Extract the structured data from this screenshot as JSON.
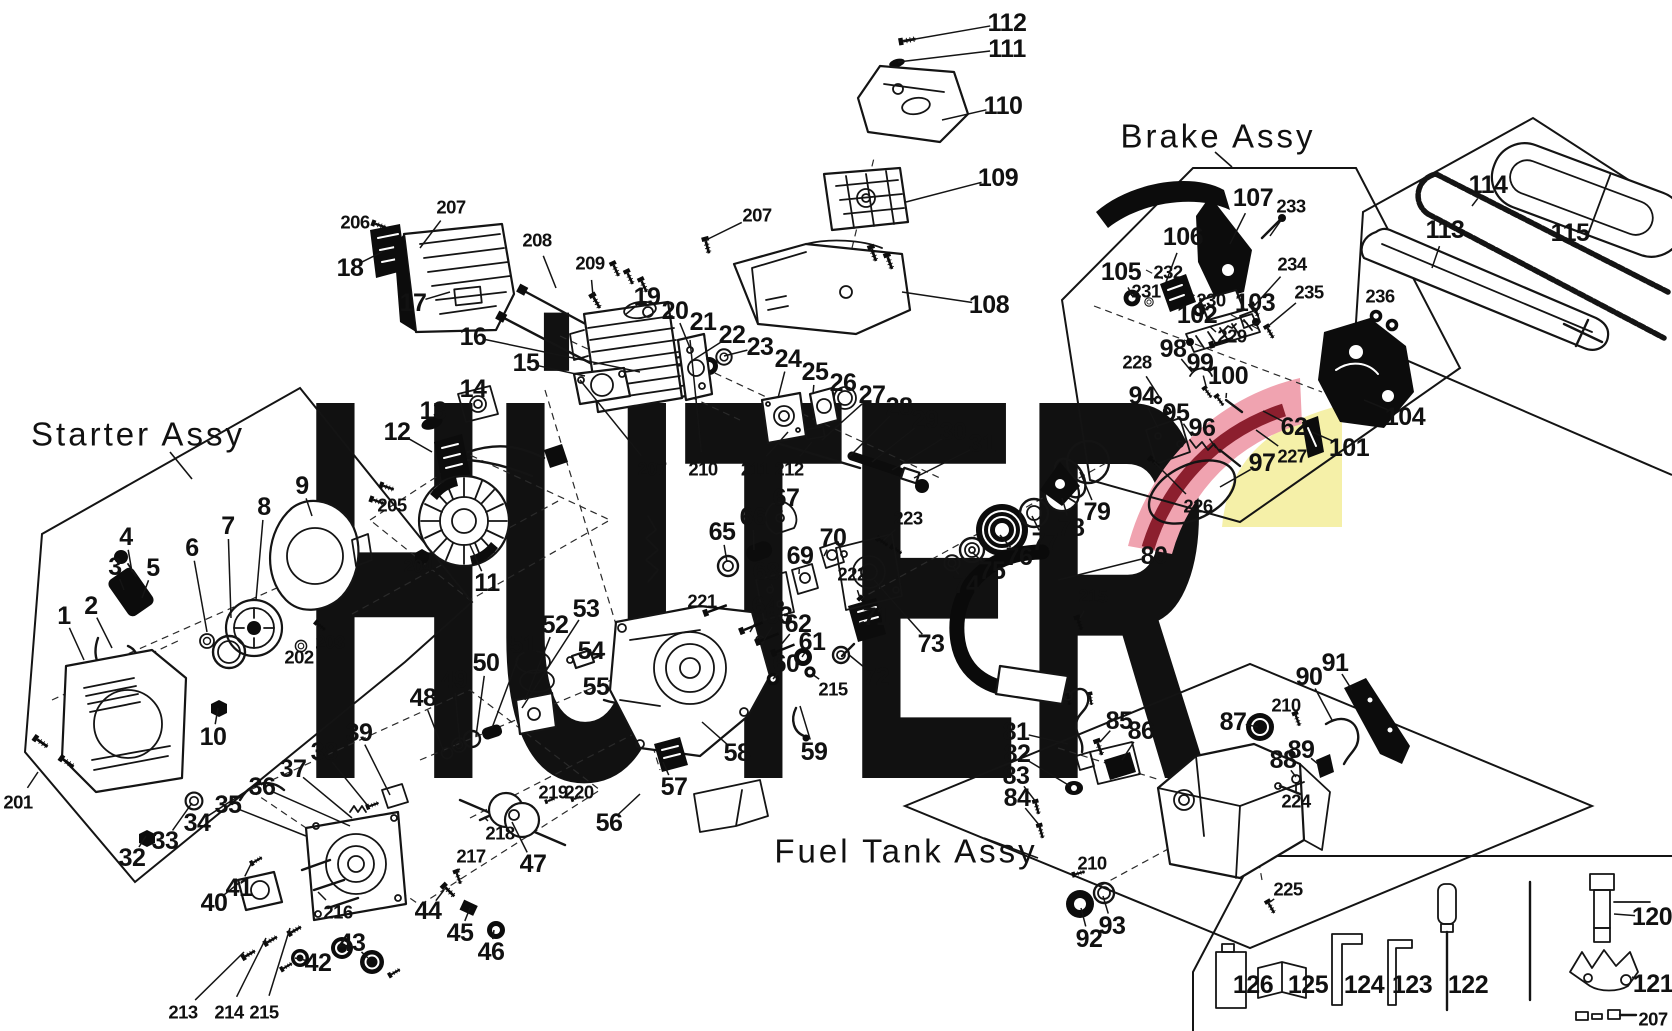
{
  "watermark": {
    "text": "HÜTER",
    "color": "#c9c9c9",
    "accent_pink": "#f0a3b0",
    "accent_red": "#8c1f2e",
    "accent_yellow": "#f5f0a8"
  },
  "assemblies": [
    {
      "label": "Starter Assy",
      "x": 138,
      "y": 434,
      "leader": [
        170,
        452,
        192,
        479
      ]
    },
    {
      "label": "Brake Assy",
      "x": 1218,
      "y": 136,
      "leader": [
        1215,
        152,
        1232,
        167
      ]
    },
    {
      "label": "Fuel Tank Assy",
      "x": 906,
      "y": 851,
      "leader": [
        984,
        838,
        1038,
        858
      ]
    }
  ],
  "part_labels": [
    [
      "1",
      64,
      616,
      84,
      660
    ],
    [
      "2",
      91,
      606,
      112,
      648
    ],
    [
      "3",
      115,
      567,
      124,
      590
    ],
    [
      "4",
      126,
      537,
      132,
      572
    ],
    [
      "5",
      153,
      568,
      142,
      598
    ],
    [
      "6",
      192,
      548,
      207,
      632
    ],
    [
      "7",
      228,
      526,
      231,
      618
    ],
    [
      "8",
      264,
      507,
      256,
      600
    ],
    [
      "9",
      302,
      486,
      312,
      516
    ],
    [
      "10",
      213,
      737,
      218,
      708
    ],
    [
      "11",
      487,
      583,
      470,
      545
    ],
    [
      "12",
      397,
      432,
      432,
      452
    ],
    [
      "13",
      433,
      411,
      430,
      424
    ],
    [
      "14",
      473,
      389,
      470,
      402
    ],
    [
      "15",
      526,
      363,
      585,
      376
    ],
    [
      "16",
      473,
      337,
      640,
      372
    ],
    [
      "17",
      413,
      303,
      450,
      292
    ],
    [
      "18",
      350,
      268,
      382,
      252
    ],
    [
      "19",
      647,
      297,
      625,
      315
    ],
    [
      "20",
      675,
      311,
      690,
      348
    ],
    [
      "21",
      703,
      322,
      707,
      360
    ],
    [
      "22",
      732,
      335,
      690,
      362
    ],
    [
      "23",
      760,
      347,
      724,
      356
    ],
    [
      "24",
      788,
      359,
      778,
      398
    ],
    [
      "25",
      815,
      372,
      813,
      394
    ],
    [
      "26",
      843,
      383,
      842,
      392
    ],
    [
      "27",
      872,
      395,
      822,
      440
    ],
    [
      "28",
      899,
      407,
      850,
      456
    ],
    [
      "29",
      925,
      420,
      872,
      462
    ],
    [
      "30",
      953,
      432,
      892,
      470
    ],
    [
      "31",
      982,
      444,
      914,
      478
    ],
    [
      "32",
      132,
      858,
      146,
      836
    ],
    [
      "33",
      165,
      841,
      192,
      803
    ],
    [
      "34",
      197,
      823,
      248,
      790
    ],
    [
      "35",
      228,
      805,
      306,
      836
    ],
    [
      "36",
      262,
      787,
      350,
      826
    ],
    [
      "37",
      293,
      769,
      352,
      818
    ],
    [
      "38",
      324,
      752,
      368,
      806
    ],
    [
      "39",
      359,
      733,
      390,
      795
    ],
    [
      "40",
      214,
      903,
      240,
      882
    ],
    [
      "41",
      239,
      888,
      252,
      862
    ],
    [
      "42",
      318,
      963,
      295,
      958
    ],
    [
      "43",
      352,
      943,
      368,
      958
    ],
    [
      "44",
      428,
      911,
      444,
      890
    ],
    [
      "45",
      460,
      933,
      470,
      908
    ],
    [
      "46",
      491,
      952,
      494,
      930
    ],
    [
      "47",
      533,
      864,
      512,
      822
    ],
    [
      "48",
      423,
      698,
      444,
      752
    ],
    [
      "49",
      454,
      680,
      460,
      744
    ],
    [
      "50",
      486,
      663,
      476,
      736
    ],
    [
      "51",
      523,
      645,
      492,
      728
    ],
    [
      "52",
      555,
      625,
      525,
      700
    ],
    [
      "53",
      586,
      609,
      522,
      708
    ],
    [
      "54",
      591,
      651,
      580,
      662
    ],
    [
      "55",
      596,
      687,
      608,
      696
    ],
    [
      "56",
      609,
      823,
      640,
      794
    ],
    [
      "57",
      674,
      787,
      663,
      762
    ],
    [
      "58",
      737,
      753,
      702,
      722
    ],
    [
      "59",
      814,
      752,
      800,
      706
    ],
    [
      "60",
      786,
      664,
      773,
      679
    ],
    [
      "61",
      812,
      642,
      802,
      657
    ],
    [
      "62",
      798,
      624,
      780,
      646
    ],
    [
      "63",
      779,
      616,
      764,
      640
    ],
    [
      "64",
      765,
      606,
      750,
      632
    ],
    [
      "65",
      722,
      532,
      727,
      562
    ],
    [
      "66",
      753,
      517,
      754,
      550
    ],
    [
      "67",
      786,
      498,
      780,
      518
    ],
    [
      "68",
      766,
      572,
      774,
      590
    ],
    [
      "69",
      800,
      556,
      799,
      574
    ],
    [
      "70",
      833,
      538,
      824,
      556
    ],
    [
      "71",
      876,
      617,
      858,
      624
    ],
    [
      "72",
      876,
      677,
      848,
      654
    ],
    [
      "73",
      931,
      644,
      874,
      580
    ],
    [
      "74",
      966,
      585,
      953,
      566
    ],
    [
      "75",
      992,
      571,
      972,
      552
    ],
    [
      "76",
      1019,
      557,
      1000,
      535
    ],
    [
      "77",
      1045,
      542,
      1032,
      516
    ],
    [
      "78",
      1071,
      528,
      1062,
      498
    ],
    [
      "79",
      1097,
      512,
      1080,
      472
    ],
    [
      "80",
      1154,
      556,
      1058,
      580
    ],
    [
      "81",
      1016,
      732,
      1068,
      744
    ],
    [
      "82",
      1017,
      754,
      1070,
      786
    ],
    [
      "83",
      1016,
      776,
      1036,
      802
    ],
    [
      "84",
      1017,
      798,
      1040,
      826
    ],
    [
      "85",
      1119,
      721,
      1100,
      742
    ],
    [
      "86",
      1141,
      731,
      1122,
      760
    ],
    [
      "87",
      1233,
      722,
      1258,
      727
    ],
    [
      "88",
      1283,
      760,
      1296,
      777
    ],
    [
      "89",
      1301,
      750,
      1318,
      764
    ],
    [
      "90",
      1309,
      677,
      1332,
      720
    ],
    [
      "91",
      1335,
      663,
      1352,
      690
    ],
    [
      "92",
      1089,
      939,
      1081,
      908
    ],
    [
      "93",
      1112,
      926,
      1103,
      896
    ],
    [
      "94",
      1142,
      396,
      1158,
      428
    ],
    [
      "95",
      1176,
      413,
      1192,
      436
    ],
    [
      "96",
      1202,
      428,
      1216,
      448
    ],
    [
      "97",
      1262,
      463,
      1220,
      487
    ],
    [
      "98",
      1173,
      349,
      1192,
      372
    ],
    [
      "99",
      1200,
      363,
      1206,
      386
    ],
    [
      "100",
      1228,
      376,
      1226,
      398
    ],
    [
      "101",
      1349,
      448,
      1312,
      432
    ],
    [
      "102",
      1197,
      315,
      1216,
      332
    ],
    [
      "103",
      1255,
      303,
      1242,
      318
    ],
    [
      "104",
      1405,
      417,
      1364,
      400
    ],
    [
      "105",
      1121,
      272,
      1132,
      296
    ],
    [
      "106",
      1183,
      237,
      1166,
      282
    ],
    [
      "107",
      1253,
      198,
      1230,
      244
    ],
    [
      "108",
      989,
      305,
      902,
      292
    ],
    [
      "109",
      998,
      178,
      906,
      202
    ],
    [
      "110",
      1003,
      106,
      942,
      120
    ],
    [
      "111",
      1007,
      49,
      898,
      62
    ],
    [
      "112",
      1007,
      23,
      904,
      41
    ],
    [
      "113",
      1445,
      230,
      1432,
      268
    ],
    [
      "114",
      1488,
      185,
      1472,
      206
    ],
    [
      "115",
      1570,
      233,
      1562,
      214
    ],
    [
      "120",
      1652,
      917,
      1614,
      914
    ],
    [
      "121",
      1653,
      984,
      1632,
      977
    ],
    [
      "122",
      1468,
      985,
      1450,
      985
    ],
    [
      "123",
      1412,
      985,
      1398,
      985
    ],
    [
      "124",
      1364,
      985,
      1348,
      985
    ],
    [
      "125",
      1308,
      985,
      1294,
      985
    ],
    [
      "126",
      1253,
      985,
      1240,
      985
    ],
    [
      "201",
      18,
      802,
      38,
      772
    ],
    [
      "202",
      299,
      657,
      301,
      648
    ],
    [
      "203",
      330,
      642,
      318,
      626
    ],
    [
      "204",
      418,
      566,
      421,
      556
    ],
    [
      "205",
      392,
      505,
      384,
      490
    ],
    [
      "206",
      355,
      222,
      374,
      225
    ],
    [
      "207",
      451,
      207,
      420,
      248
    ],
    [
      "207",
      757,
      215,
      706,
      240
    ],
    [
      "207",
      652,
      469,
      580,
      380
    ],
    [
      "207",
      1653,
      1019,
      1634,
      1018
    ],
    [
      "208",
      537,
      240,
      556,
      288
    ],
    [
      "209",
      590,
      263,
      593,
      296
    ],
    [
      "210",
      703,
      469,
      690,
      340
    ],
    [
      "210",
      1286,
      705,
      1296,
      714
    ],
    [
      "210",
      1092,
      863,
      1078,
      872
    ],
    [
      "211",
      755,
      469,
      788,
      432
    ],
    [
      "212",
      789,
      469,
      812,
      442
    ],
    [
      "213",
      183,
      1012,
      244,
      952
    ],
    [
      "214",
      229,
      1012,
      266,
      938
    ],
    [
      "215",
      264,
      1012,
      290,
      928
    ],
    [
      "215",
      833,
      689,
      812,
      674
    ],
    [
      "215",
      1093,
      596,
      1080,
      618
    ],
    [
      "216",
      338,
      912,
      318,
      892
    ],
    [
      "217",
      471,
      856,
      457,
      872
    ],
    [
      "218",
      500,
      833,
      484,
      817
    ],
    [
      "219",
      553,
      792,
      548,
      800
    ],
    [
      "220",
      579,
      792,
      574,
      800
    ],
    [
      "221",
      702,
      601,
      714,
      610
    ],
    [
      "222",
      852,
      574,
      860,
      598
    ],
    [
      "223",
      908,
      518,
      884,
      540
    ],
    [
      "224",
      1296,
      801,
      1290,
      784
    ],
    [
      "225",
      1288,
      889,
      1270,
      902
    ],
    [
      "226",
      1198,
      506,
      1154,
      462
    ],
    [
      "227",
      1292,
      456,
      1256,
      430
    ],
    [
      "228",
      1137,
      362,
      1160,
      398
    ],
    [
      "229",
      1232,
      336,
      1221,
      341
    ],
    [
      "230",
      1211,
      300,
      1199,
      309
    ],
    [
      "231",
      1146,
      291,
      1149,
      300
    ],
    [
      "232",
      1168,
      272,
      1174,
      288
    ],
    [
      "233",
      1291,
      206,
      1270,
      236
    ],
    [
      "234",
      1292,
      264,
      1254,
      306
    ],
    [
      "235",
      1309,
      292,
      1266,
      328
    ],
    [
      "236",
      1380,
      296,
      1376,
      315
    ],
    [
      "62",
      1294,
      427,
      1263,
      411
    ]
  ]
}
